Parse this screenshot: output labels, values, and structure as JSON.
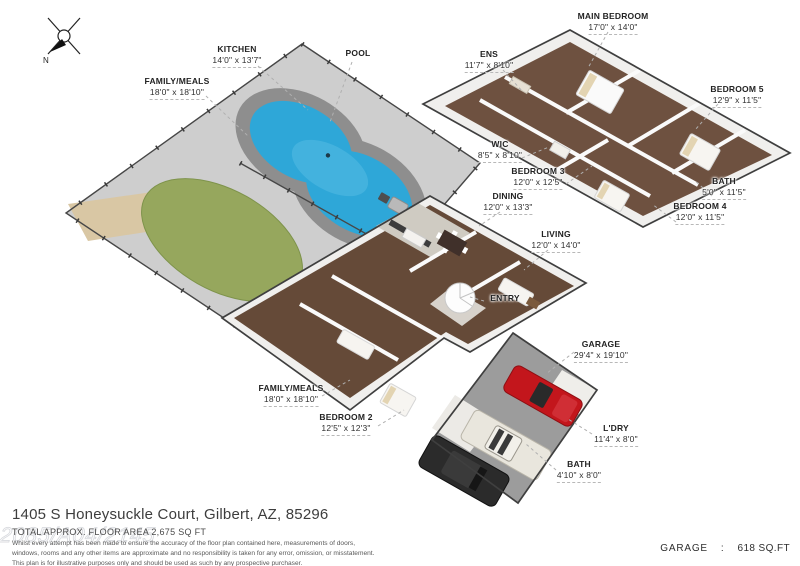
{
  "compass": {
    "north_label": "N"
  },
  "rooms": [
    {
      "label": "KITCHEN",
      "dims": "14'0\" x 13'7\""
    },
    {
      "label": "POOL",
      "dims": ""
    },
    {
      "label": "FAMILY/MEALS",
      "dims": "18'0\" x 18'10\""
    },
    {
      "label": "MAIN BEDROOM",
      "dims": "17'0\" x 14'0\""
    },
    {
      "label": "ENS",
      "dims": "11'7\" x 8'10\""
    },
    {
      "label": "BEDROOM 5",
      "dims": "12'9\" x 11'5\""
    },
    {
      "label": "WIC",
      "dims": "8'5\" x 8'10\""
    },
    {
      "label": "BEDROOM 3",
      "dims": "12'0\" x 12'5\""
    },
    {
      "label": "DINING",
      "dims": "12'0\" x 13'3\""
    },
    {
      "label": "BATH",
      "dims": "5'0\" x 11'5\""
    },
    {
      "label": "BEDROOM 4",
      "dims": "12'0\" x 11'5\""
    },
    {
      "label": "LIVING",
      "dims": "12'0\" x 14'0\""
    },
    {
      "label": "ENTRY",
      "dims": ""
    },
    {
      "label": "GARAGE",
      "dims": "29'4\" x 19'10\""
    },
    {
      "label": "FAMILY/MEALS",
      "dims": "18'0\" x 18'10\""
    },
    {
      "label": "BEDROOM 2",
      "dims": "12'5\" x 12'3\""
    },
    {
      "label": "L'DRY",
      "dims": "11'4\" x 8'0\""
    },
    {
      "label": "BATH",
      "dims": "4'10\" x 8'0\""
    }
  ],
  "footer": {
    "address": "1405 S Honeysuckle Court, Gilbert, AZ, 85296",
    "total_area_line": "TOTAL APPROX. FLOOR AREA 2,675 SQ FT",
    "disclaimer_line1": "Whilst every attempt has been made to ensure the accuracy of the floor plan contained here, measurements of doors,",
    "disclaimer_line2": "windows, rooms and any other items are approximate and no responsibility is taken for any error, omission, or misstatement.",
    "disclaimer_line3": "This plan is for illustrative purposes only and should be used as such by any prospective purchaser.",
    "watermark": "2085/A04/2145"
  },
  "garage_summary": {
    "label": "GARAGE",
    "divider": ":",
    "area": "618 SQ.FT"
  },
  "colors": {
    "pool_water": "#2ea7d8",
    "pool_surround": "#8e8e8e",
    "grass": "#96a75d",
    "deck": "#cecece",
    "wood_floor": "#6b4e3b",
    "garage_floor": "#9c9c9c",
    "car_red": "#c3161c",
    "car_white": "#e9e6dd",
    "car_black": "#2b2b2b"
  }
}
